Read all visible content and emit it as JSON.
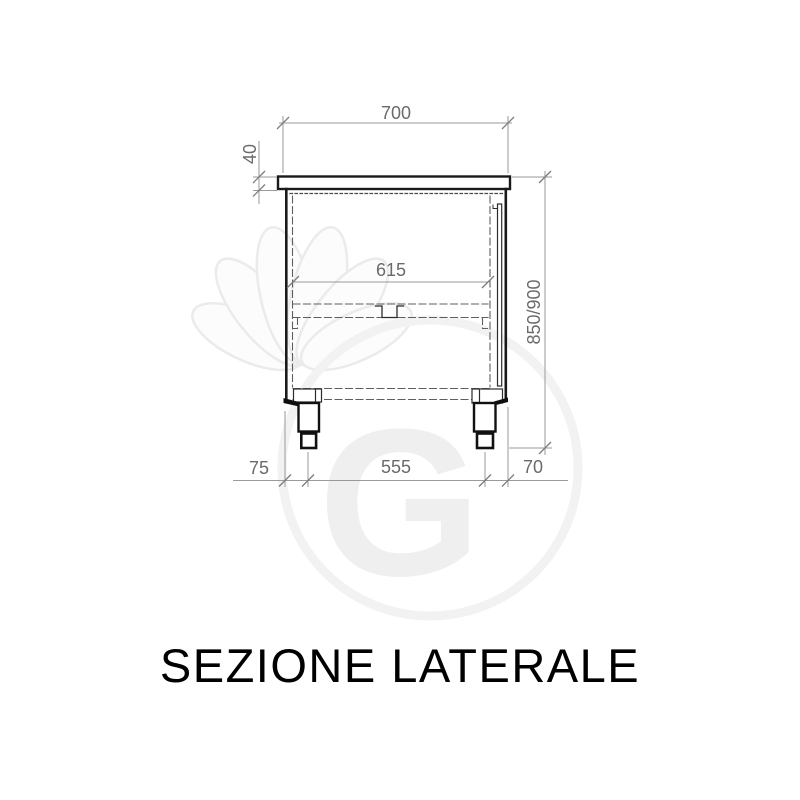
{
  "title": "SEZIONE LATERALE",
  "watermark": {
    "letter": "G"
  },
  "drawing": {
    "type": "technical-section-drawing",
    "subject": "cabinet side section with worktop, intermediate shelf and two adjustable feet",
    "dimensions": {
      "top_width": "700",
      "worktop_thickness": "40",
      "inner_width": "615",
      "overall_height": "850/900",
      "bottom_left_offset": "75",
      "feet_spacing": "555",
      "bottom_right_offset": "70"
    },
    "colors": {
      "outline": "#1a1a1a",
      "hidden_line": "#5f5f5f",
      "dimension_line": "#9a9a9a",
      "dimension_tick": "#7d7d7d",
      "dimension_text": "#6a6a6a",
      "title_text": "#000000",
      "watermark": "#ededed"
    }
  }
}
